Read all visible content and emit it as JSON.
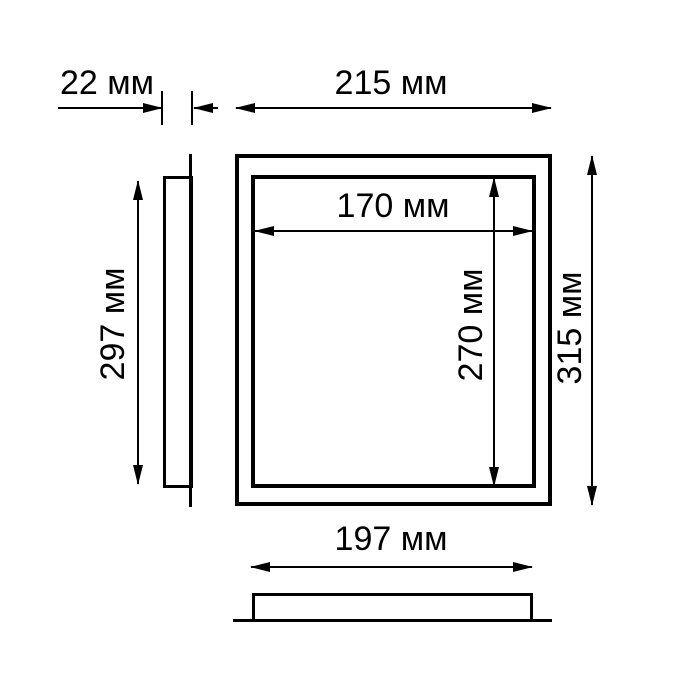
{
  "colors": {
    "background": "#ffffff",
    "line": "#000000",
    "text": "#000000"
  },
  "unit": "мм",
  "dimensions": {
    "depth": {
      "value": 22,
      "unit": "мм",
      "label": "22 мм"
    },
    "outer_width": {
      "value": 215,
      "unit": "мм",
      "label": "215 мм"
    },
    "inner_width": {
      "value": 170,
      "unit": "мм",
      "label": "170 мм"
    },
    "inner_height": {
      "value": 270,
      "unit": "мм",
      "label": "270 мм"
    },
    "outer_height": {
      "value": 315,
      "unit": "мм",
      "label": "315 мм"
    },
    "side_height": {
      "value": 297,
      "unit": "мм",
      "label": "297 мм"
    },
    "body_width": {
      "value": 197,
      "unit": "мм",
      "label": "197 мм"
    }
  }
}
